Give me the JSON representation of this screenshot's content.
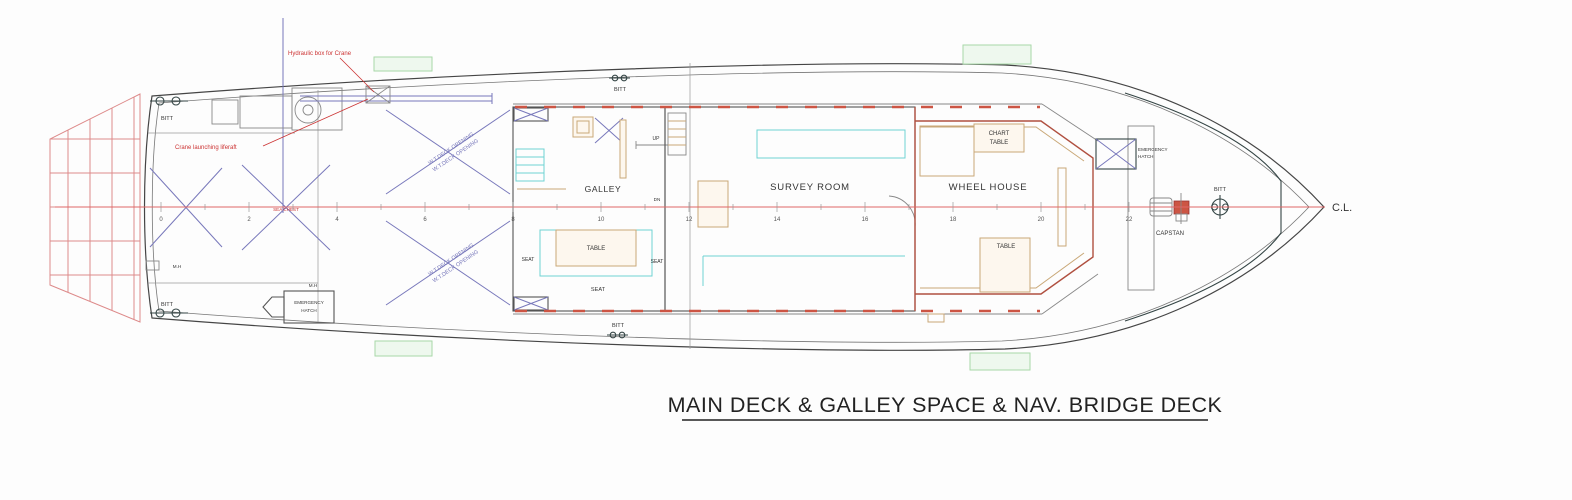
{
  "title": {
    "text": "MAIN DECK & GALLEY SPACE & NAV. BRIDGE DECK"
  },
  "centerline": {
    "label": "C.L.",
    "stations": [
      0,
      2,
      4,
      6,
      8,
      10,
      12,
      14,
      16,
      18,
      20,
      22
    ]
  },
  "rooms": {
    "galley": "GALLEY",
    "survey_room": "SURVEY ROOM",
    "wheel_house": "WHEEL HOUSE"
  },
  "furniture": {
    "chart_table_line1": "CHART",
    "chart_table_line2": "TABLE",
    "galley_table": "TABLE",
    "wheelhouse_table": "TABLE",
    "seat_left": "SEAT",
    "seat_right": "SEAT",
    "seat_bottom": "SEAT"
  },
  "stairs": {
    "up": "UP",
    "down": "DN"
  },
  "fittings": {
    "bitt": "BITT",
    "capstan": "CAPSTAN",
    "manhole": "M.H"
  },
  "hatch": {
    "line1": "EMERGENCY",
    "line2": "HATCH"
  },
  "annotations": {
    "hydraulic_box": "Hydraulic box for Crane",
    "crane_liferaft": "Crane launching liferaft",
    "deck_opening": "W.T.DECK OPENING",
    "sea_chest": "SEA CHEST"
  },
  "colors": {
    "centerline": "#e06666",
    "hull": "#454545",
    "stern_grid": "#dd8a8a",
    "brace": "#7878bb",
    "seat_cyan": "#6fd2d2",
    "furniture_tan": "#c9a878",
    "window_red": "#cc5544",
    "liferaft_green": "#a8d8a8",
    "annotation_red": "#cc3333",
    "bulkhead": "#b05040"
  }
}
